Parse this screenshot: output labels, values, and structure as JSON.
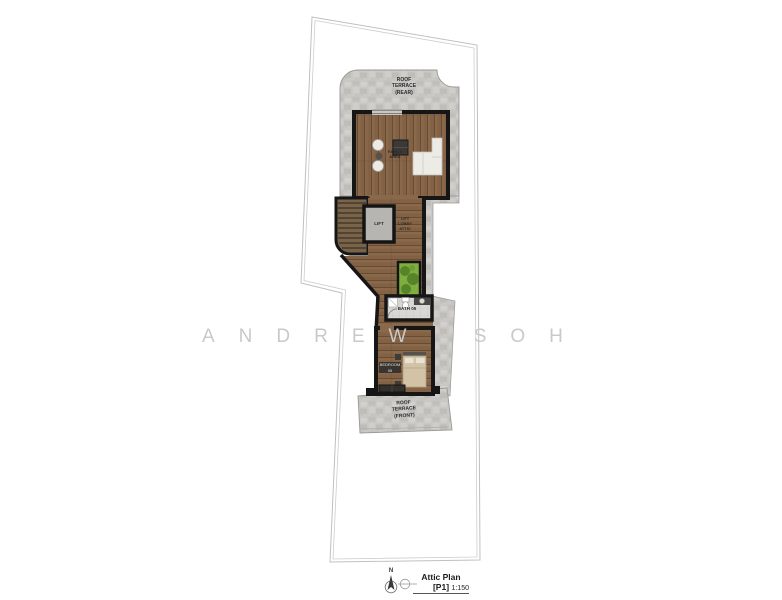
{
  "watermark": {
    "text": "ANDREW SOH"
  },
  "plan": {
    "labels": {
      "roof_terrace_rear": "ROOF\nTERRACE\n(REAR)",
      "family_area": "FAMILY\nAREA",
      "lift": "LIFT",
      "lift_lobby": "LIFT\nLOBBY\nATTIC",
      "bath": "BATH 05",
      "bedroom": "BEDROOM 05",
      "roof_terrace_front": "ROOF\nTERRACE\n(FRONT)"
    }
  },
  "legend": {
    "north_label": "N",
    "title": "Attic Plan [P1]",
    "scale": "1:150"
  },
  "colors": {
    "wall": "#161616",
    "wood": "#8a684a",
    "wood_dark": "#5e452f",
    "stone": "#cac8c4",
    "tile": "#dad8d4",
    "lift_gray": "#b7b5b1",
    "planter_green": "#7fae3f",
    "foliage_green": "#4e7d26",
    "bed_tan": "#d2c3a6",
    "sofa_white": "#edebe6",
    "boundary_gray": "#c2c0bd",
    "watermark_gray": "#c9c9c9",
    "label_color": "#2b2b2b"
  }
}
